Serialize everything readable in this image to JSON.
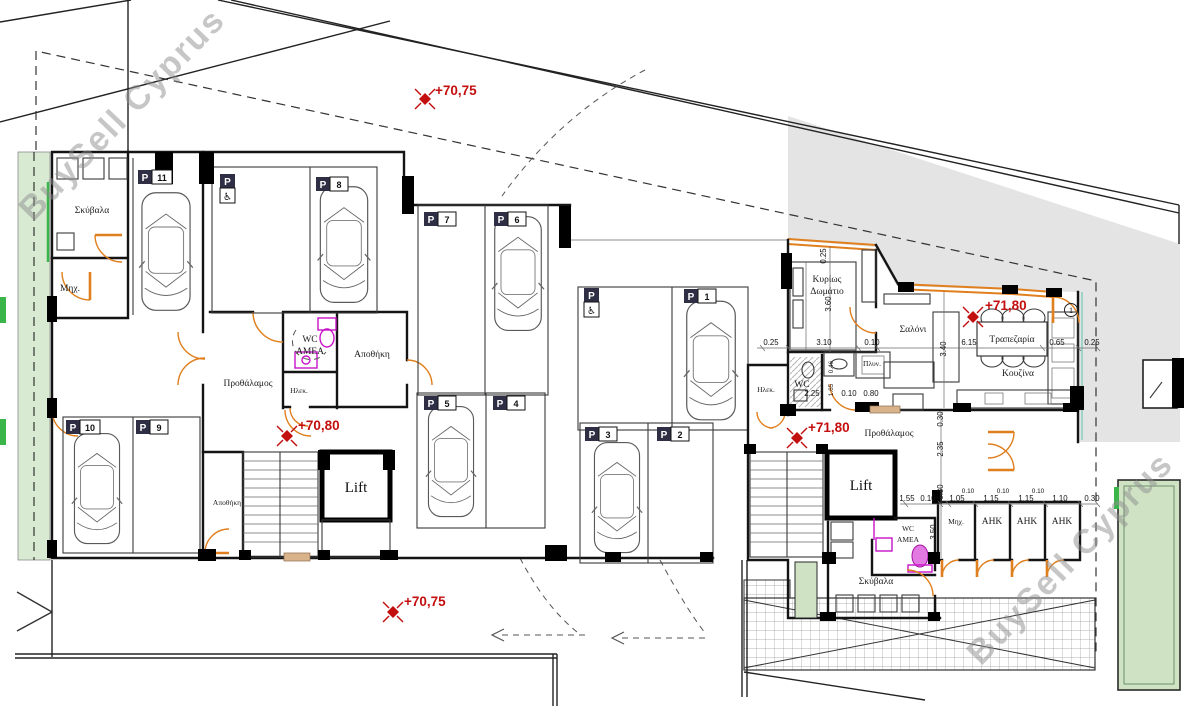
{
  "watermark": {
    "text": "BuySell Cyprus"
  },
  "colors": {
    "wall": "#141414",
    "door_orange": "#e07f1e",
    "amea_magenta": "#c813c8",
    "level_red": "#c40f0f",
    "neighbor_gray": "#e4e4e4",
    "planting_green": "#d9ead3",
    "bright_green": "#39b54a",
    "watermark_gray": "#8f8f8f"
  },
  "levels": {
    "street_top": "+70,75",
    "garage": "+70,80",
    "apartment": "+71,80",
    "entrance": "+71,80",
    "street_bottom": "+70,75"
  },
  "parking": {
    "letter": "P",
    "accessible_icon": "♿",
    "spots": {
      "p1": "1",
      "p2": "2",
      "p3": "3",
      "p4": "4",
      "p5": "5",
      "p6": "6",
      "p7": "7",
      "p8": "8",
      "p9": "9",
      "p10": "10",
      "p11": "11"
    }
  },
  "rooms": {
    "garbage": "Σκύβαλα",
    "mechanical": "Μηχ.",
    "wc": "WC",
    "amea": "ΑΜΕΑ",
    "storage": "Αποθήκη",
    "vestibule": "Προθάλαμος",
    "electrical": "Ηλεκ.",
    "lift": "Lift",
    "bedroom_line1": "Κυρίως",
    "bedroom_line2": "Δωμάτιο",
    "living": "Σαλόνι",
    "dining": "Τραπεζαρία",
    "kitchen": "Κουζίνα",
    "laundry": "Πλυν.",
    "utility": "AHK",
    "entrance_number": "1"
  },
  "dims": {
    "apartment_h": [
      "0.25",
      "3.10",
      "0.10",
      "6.15",
      "0.65",
      "0.25"
    ],
    "apartment_v": [
      "0.25",
      "3.60",
      "3.40"
    ],
    "wc_h": [
      "2.25",
      "0.10",
      "0.80"
    ],
    "wc_v": [
      "0.46",
      "1.65"
    ],
    "entry_v": [
      "0.30",
      "2.35",
      "0.30",
      "3.50"
    ],
    "entry_h": [
      "1.55",
      "0.10",
      "1.05",
      "1.15",
      "1.15",
      "1.10",
      "0.30"
    ],
    "entry_small": [
      "0.10",
      "0.10",
      "0.10"
    ]
  }
}
